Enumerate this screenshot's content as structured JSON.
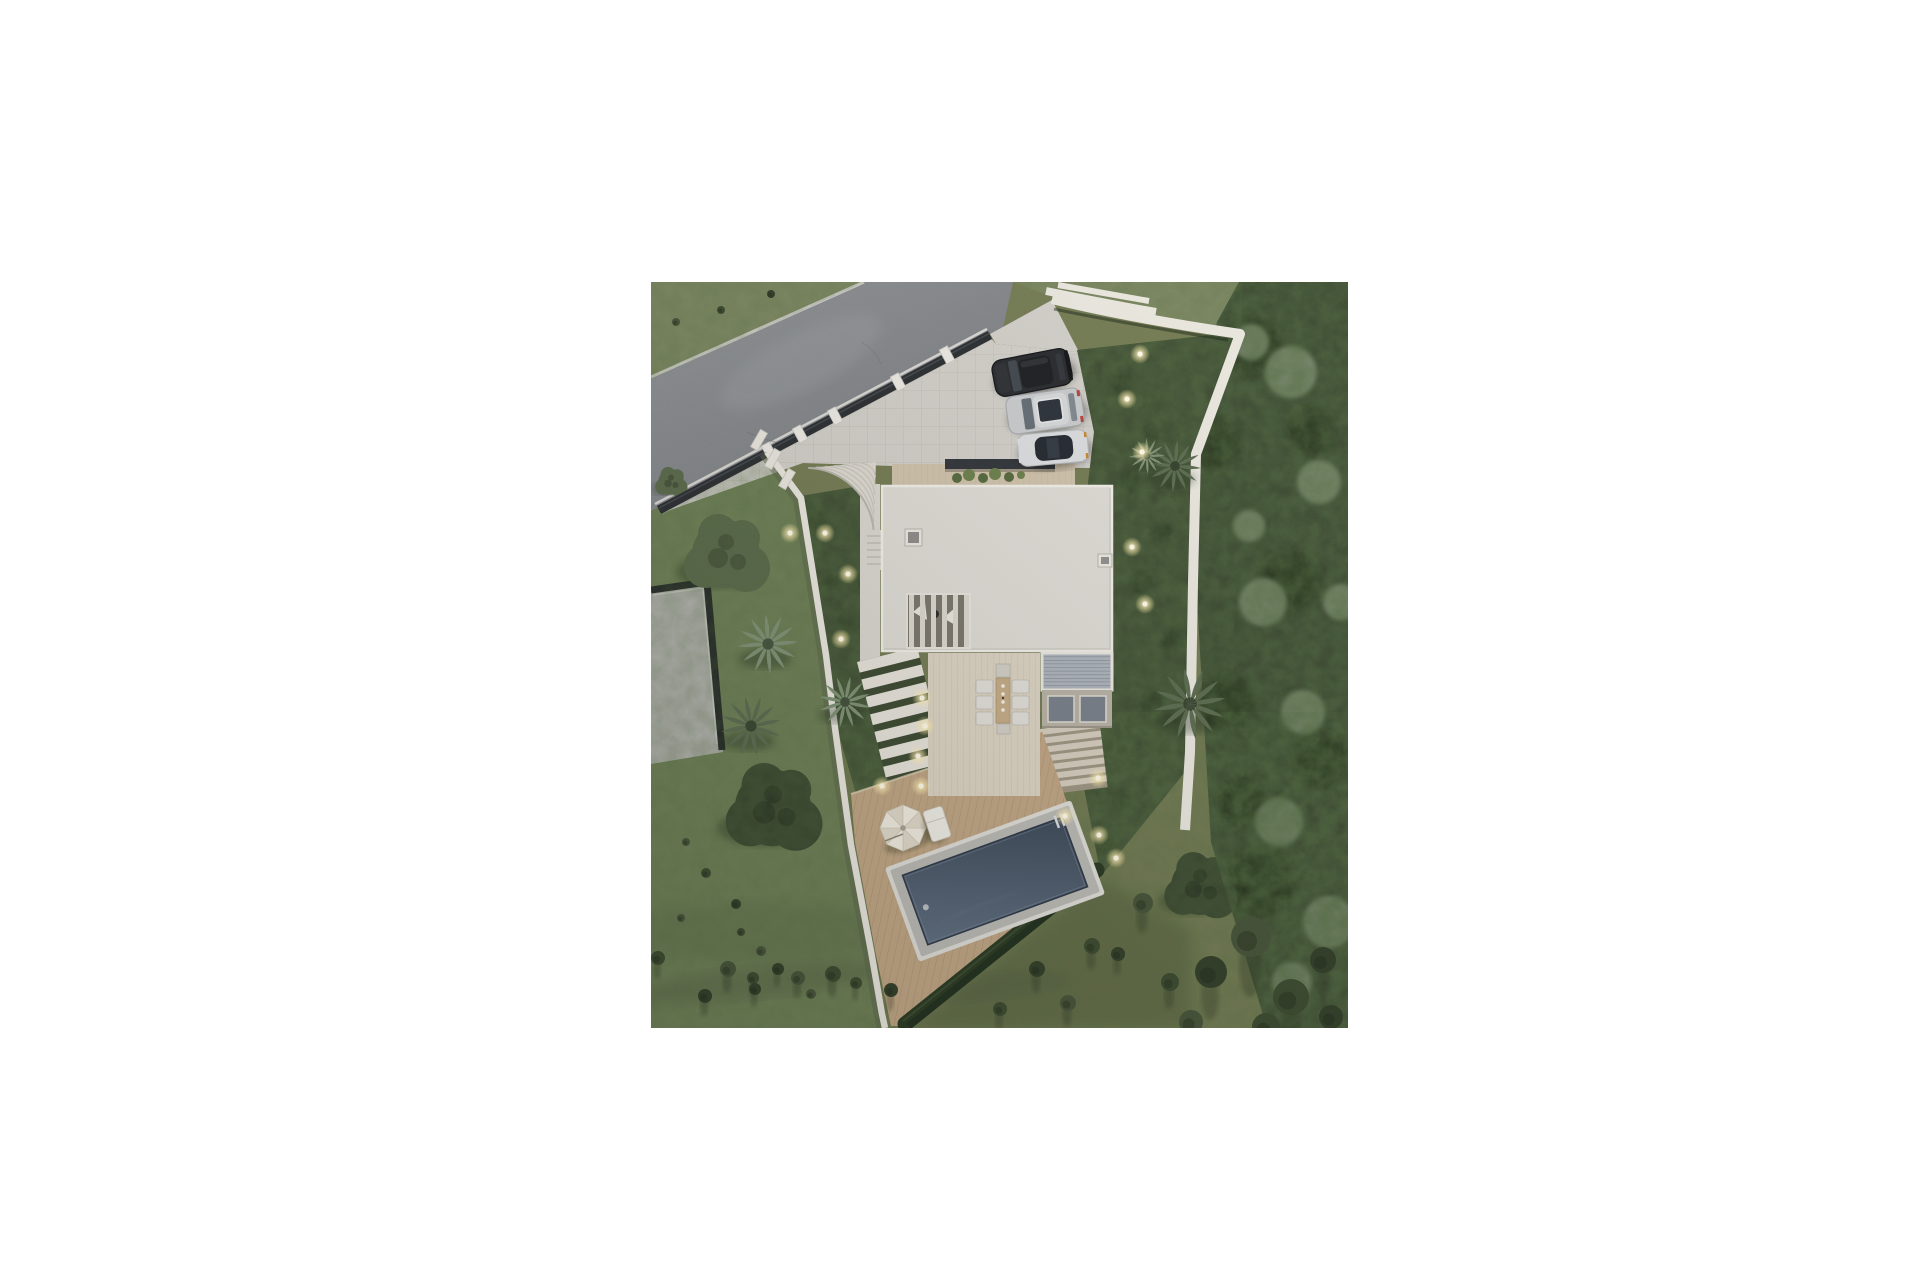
{
  "page": {
    "background": "#ffffff",
    "canvas_width": 1920,
    "canvas_height": 1280
  },
  "photo": {
    "alt": "Aerial top-down dusk 3D rendering of a modern flat-roof villa plot: diagonal asphalt road with dark fence and white pillars, paved driveway with three parked cars, curved staircase, white boundary walls, terraced gardens with glowing path lights and palm trees, outdoor dining terrace with pergola, wooden pool deck with parasol and lounger, rectangular dark-blue swimming pool edged by a hedge, neighbouring flat-roof building, lawns, scrub field and dense dark woodland",
    "width": 697,
    "height": 746
  },
  "palette": {
    "page_bg": "#ffffff",
    "field": "#717853",
    "lawn": "#6f7f58",
    "grass_top": "#7d8663",
    "road_light": "#8d9094",
    "road_dark": "#76787c",
    "curb": "#d6d4d0",
    "fence": "#2e3134",
    "pillar": "#eae7e1",
    "pave": "#cfccc6",
    "wall": "#e7e4dc",
    "wall_shadow": "#59624a",
    "roof": "#dcd9d3",
    "roof_edge": "#efece6",
    "walkway": "#d7d4cd",
    "wood_north": "#cdbfa8",
    "terrace": "#d9d0bf",
    "deck": "#bda181",
    "steps": "#e5e1d9",
    "steps_se": "#d3cabb",
    "garden": "#3e4a33",
    "hedge": "#2c3a25",
    "hedge_dark": "#223020",
    "forest": "#3a4631",
    "forest_dark": "#27331f",
    "clump": "#8d9b81",
    "palm": "#7b8d72",
    "palm_dark": "#5a6a50",
    "tree_olive": "#5a684c",
    "tree_dark": "#394630",
    "bush": "#333f2a",
    "shadow": "#232b1b",
    "coping": "#b7b6b2",
    "coping_rim": "#dcdad5",
    "pool_deep": "#3e4958",
    "pool_light": "#5e6c7e",
    "slat": "#aab0b8",
    "frame": "#e8e5de",
    "glass": "#757c86",
    "dark_bar": "#34373b",
    "car_black": "#2b2d30",
    "car_silver": "#c6c8ca",
    "car_white": "#d8dadc",
    "light_core": "#fff9e6",
    "light_glow": "#ffe9a6",
    "umbrella": "#ece7db",
    "chair": "#dfdcd6",
    "wood_table": "#c2a883",
    "neighbor_roof": "#b4b4b0",
    "parapet": "#232527"
  },
  "scene": {
    "cars": [
      {
        "name": "black-suv",
        "body": "#2b2d30"
      },
      {
        "name": "silver-suv",
        "body": "#c6c8ca"
      },
      {
        "name": "white-coupe",
        "body": "#d8dadc"
      }
    ],
    "counts": {
      "parked_cars": 3,
      "garden_lights": 18,
      "palm_trees": 6,
      "pools": 1,
      "parasols": 1
    },
    "lights": [
      [
        489,
        72
      ],
      [
        476,
        117
      ],
      [
        491,
        170
      ],
      [
        481,
        265
      ],
      [
        494,
        322
      ],
      [
        447,
        496
      ],
      [
        414,
        534
      ],
      [
        448,
        553
      ],
      [
        465,
        576
      ],
      [
        271,
        416
      ],
      [
        274,
        444
      ],
      [
        267,
        474
      ],
      [
        231,
        504
      ],
      [
        270,
        504
      ],
      [
        139,
        251
      ],
      [
        174,
        251
      ],
      [
        197,
        292
      ],
      [
        190,
        357
      ]
    ],
    "bushes": [
      [
        7,
        676,
        7
      ],
      [
        54,
        714,
        7
      ],
      [
        77,
        687,
        8
      ],
      [
        102,
        696,
        6
      ],
      [
        127,
        687,
        6
      ],
      [
        147,
        696,
        7
      ],
      [
        182,
        692,
        8
      ],
      [
        104,
        707,
        6
      ],
      [
        160,
        712,
        5
      ],
      [
        205,
        701,
        6
      ],
      [
        240,
        708,
        7
      ],
      [
        30,
        636,
        4
      ],
      [
        55,
        591,
        5
      ],
      [
        85,
        622,
        5
      ],
      [
        110,
        669,
        5
      ],
      [
        349,
        727,
        7
      ],
      [
        386,
        687,
        8
      ],
      [
        417,
        721,
        8
      ],
      [
        441,
        664,
        8
      ],
      [
        467,
        672,
        7
      ],
      [
        492,
        621,
        10
      ],
      [
        519,
        700,
        9
      ],
      [
        560,
        690,
        16
      ],
      [
        600,
        655,
        20
      ],
      [
        640,
        715,
        18
      ],
      [
        672,
        678,
        13
      ],
      [
        540,
        740,
        12
      ],
      [
        615,
        745,
        14
      ],
      [
        680,
        735,
        12
      ],
      [
        25,
        40,
        4
      ],
      [
        70,
        28,
        4
      ],
      [
        120,
        12,
        4
      ],
      [
        35,
        560,
        4
      ],
      [
        90,
        650,
        4
      ]
    ],
    "palms": [
      [
        117,
        362,
        30
      ],
      [
        100,
        444,
        30
      ],
      [
        194,
        420,
        26
      ],
      [
        524,
        184,
        26
      ],
      [
        496,
        174,
        18
      ],
      [
        539,
        422,
        36
      ]
    ],
    "trees": [
      [
        75,
        272,
        40,
        "olive"
      ],
      [
        122,
        526,
        45,
        "dark"
      ],
      [
        20,
        200,
        15,
        "olive"
      ],
      [
        549,
        604,
        34,
        "dark"
      ]
    ],
    "forest_blobs": [
      [
        560,
        160,
        28
      ],
      [
        600,
        64,
        30
      ],
      [
        575,
        420,
        28
      ],
      [
        608,
        600,
        36
      ],
      [
        640,
        300,
        30
      ],
      [
        590,
        520,
        26
      ],
      [
        660,
        150,
        24
      ],
      [
        670,
        480,
        28
      ]
    ],
    "forest_clumps": [
      [
        640,
        90,
        26
      ],
      [
        668,
        200,
        22
      ],
      [
        612,
        320,
        24
      ],
      [
        652,
        430,
        22
      ],
      [
        628,
        540,
        24
      ],
      [
        598,
        244,
        16
      ],
      [
        678,
        640,
        26
      ],
      [
        641,
        700,
        20
      ],
      [
        600,
        60,
        18
      ],
      [
        690,
        320,
        18
      ]
    ]
  }
}
